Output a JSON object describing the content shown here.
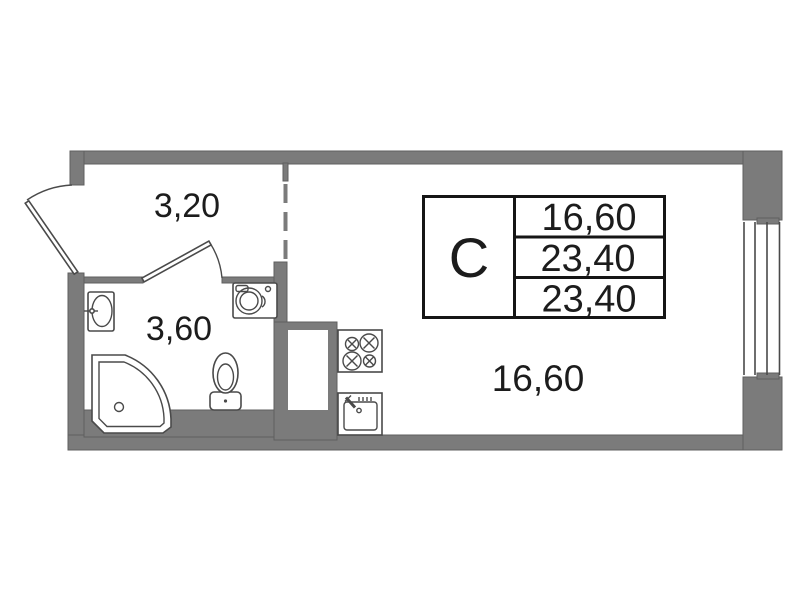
{
  "floorplan": {
    "info_table": {
      "type_label": "С",
      "values": [
        "16,60",
        "23,40",
        "23,40"
      ]
    },
    "rooms": {
      "hallway": {
        "area": "3,20"
      },
      "bathroom": {
        "area": "3,60"
      },
      "main_room": {
        "area": "16,60"
      }
    },
    "colors": {
      "background": "#ffffff",
      "wall": "#7b7b7b",
      "wall-edge": "#5f5f5f",
      "line": "#4a4a4a",
      "table-border": "#151515",
      "text": "#1c1c1c"
    }
  }
}
